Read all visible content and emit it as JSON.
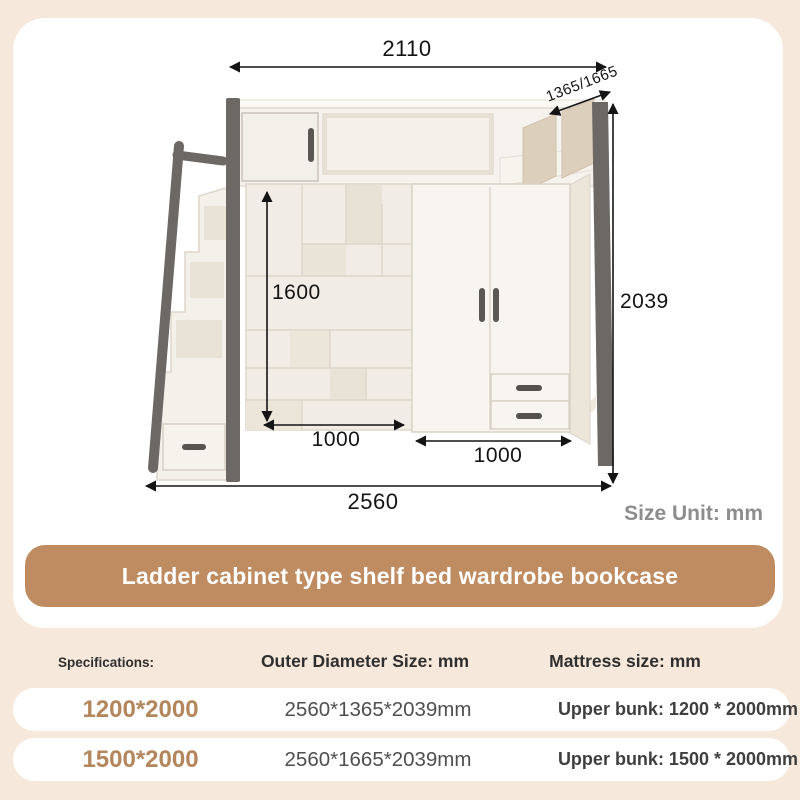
{
  "diagram": {
    "size_unit": "Size Unit: mm",
    "dimensions": {
      "top_width": "2110",
      "depth": "1365/1665",
      "total_height": "2039",
      "shelf_inner_height": "1600",
      "bookcase_width": "1000",
      "wardrobe_width": "1000",
      "base_width": "2560"
    }
  },
  "banner": {
    "title": "Ladder cabinet type shelf bed wardrobe bookcase"
  },
  "table": {
    "headers": [
      "Specifications:",
      "Outer Diameter Size: mm",
      "Mattress size: mm"
    ],
    "rows": [
      {
        "spec": "1200*2000",
        "outer": "2560*1365*2039mm",
        "mattress": "Upper bunk: 1200 * 2000mm"
      },
      {
        "spec": "1500*2000",
        "outer": "2560*1665*2039mm",
        "mattress": "Upper bunk: 1500 * 2000mm"
      }
    ]
  },
  "colors": {
    "page_background": "#f6e9db",
    "banner_accent": "#bf8b60",
    "spec_text": "#b3865c",
    "frame_gray": "#6b6865"
  }
}
